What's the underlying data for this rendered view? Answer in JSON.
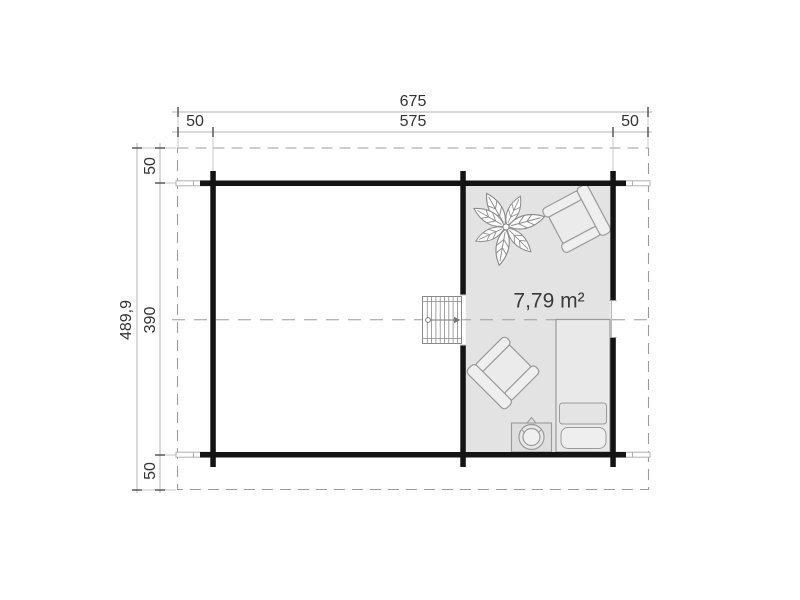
{
  "plan": {
    "area_label": "7,79 m²",
    "dim_top": {
      "total": "675",
      "inner": "575",
      "overhang_left": "50",
      "overhang_right": "50"
    },
    "dim_left": {
      "total": "489,9",
      "inner": "390",
      "overhang_top": "50",
      "overhang_bottom": "50"
    },
    "furniture": {
      "plant": "potted-plant",
      "armchair_upper": "armchair",
      "armchair_lower": "armchair",
      "bed": "single-bed",
      "stove": "round-stove",
      "stairs": "staircase-up-arrow"
    },
    "colors": {
      "wall": "#141414",
      "room_fill": "#e3e3e3",
      "furniture_outline": "#9a9a9a",
      "dashed_line": "#9b9b9b",
      "dimension_line": "#b3b3b3",
      "tick": "#4d4d4d",
      "text": "#333333"
    }
  }
}
